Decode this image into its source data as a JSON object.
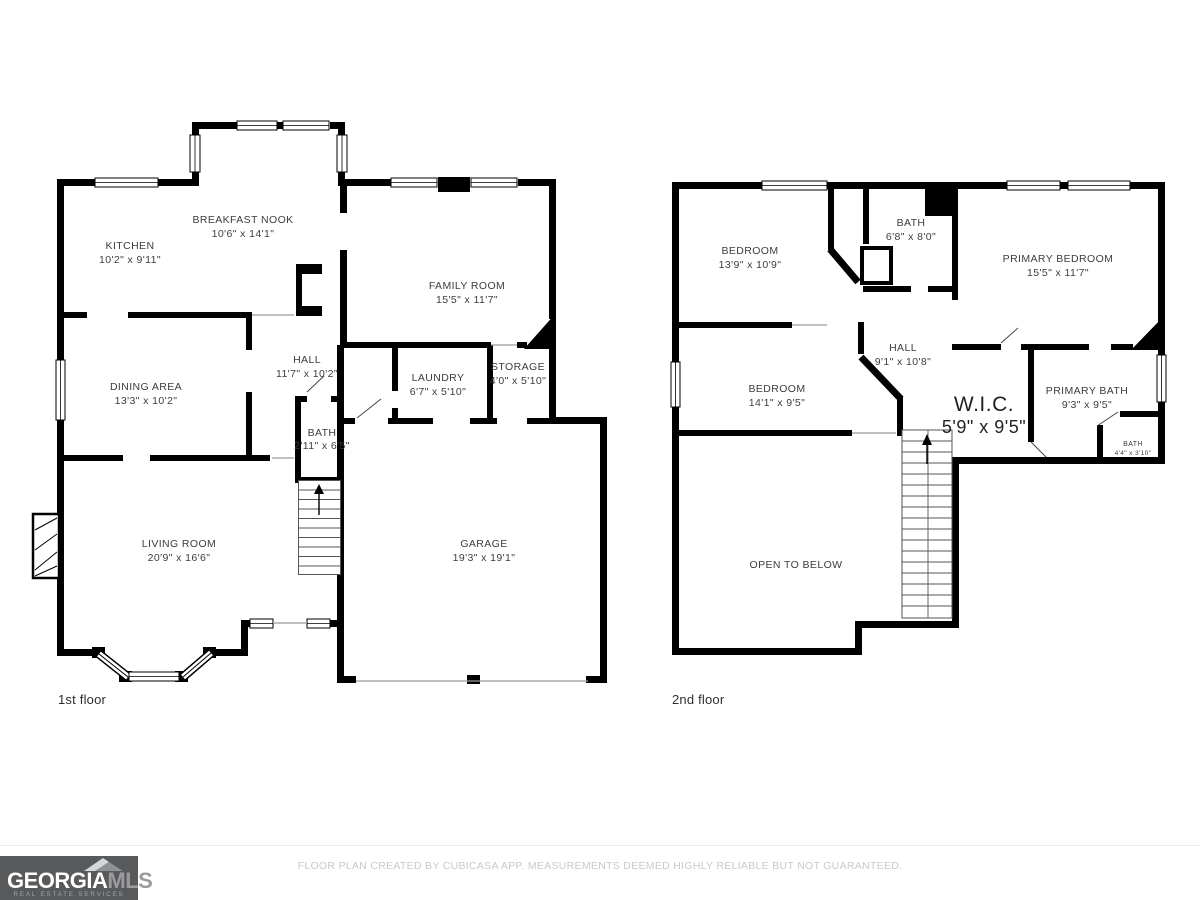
{
  "floors": [
    {
      "label": "1st floor",
      "rooms": [
        {
          "name": "KITCHEN",
          "dims": "10'2\" x 9'11\""
        },
        {
          "name": "BREAKFAST NOOK",
          "dims": "10'6\" x 14'1\""
        },
        {
          "name": "FAMILY ROOM",
          "dims": "15'5\" x 11'7\""
        },
        {
          "name": "DINING AREA",
          "dims": "13'3\" x 10'2\""
        },
        {
          "name": "HALL",
          "dims": "11'7\" x 10'2\""
        },
        {
          "name": "LAUNDRY",
          "dims": "6'7\" x 5'10\""
        },
        {
          "name": "STORAGE",
          "dims": "4'0\" x 5'10\""
        },
        {
          "name": "BATH",
          "dims": "2'11\" x 6'5\""
        },
        {
          "name": "LIVING ROOM",
          "dims": "20'9\" x 16'6\""
        },
        {
          "name": "GARAGE",
          "dims": "19'3\" x 19'1\""
        }
      ]
    },
    {
      "label": "2nd floor",
      "rooms": [
        {
          "name": "BEDROOM",
          "dims": "13'9\" x 10'9\""
        },
        {
          "name": "BATH",
          "dims": "6'8\" x 8'0\""
        },
        {
          "name": "PRIMARY BEDROOM",
          "dims": "15'5\" x 11'7\""
        },
        {
          "name": "BEDROOM",
          "dims": "14'1\" x 9'5\""
        },
        {
          "name": "HALL",
          "dims": "9'1\" x 10'8\""
        },
        {
          "name": "W.I.C.",
          "dims": "5'9\" x 9'5\""
        },
        {
          "name": "PRIMARY BATH",
          "dims": "9'3\" x 9'5\""
        },
        {
          "name": "BATH",
          "dims": "4'4\" x 3'10\""
        },
        {
          "name": "OPEN TO BELOW",
          "dims": ""
        }
      ]
    }
  ],
  "footer": {
    "logo": {
      "name_part1": "GEORGIA",
      "name_part2": "MLS",
      "tagline": "REAL ESTATE SERVICES",
      "bg_color": "#58595b"
    },
    "disclaimer": "FLOOR PLAN CREATED BY CUBICASA APP. MEASUREMENTS DEEMED HIGHLY RELIABLE BUT NOT GUARANTEED."
  },
  "colors": {
    "wall": "#000000",
    "background": "#ffffff",
    "label_text": "#3d3d3d",
    "disclaimer_text": "#c9c9c9"
  }
}
